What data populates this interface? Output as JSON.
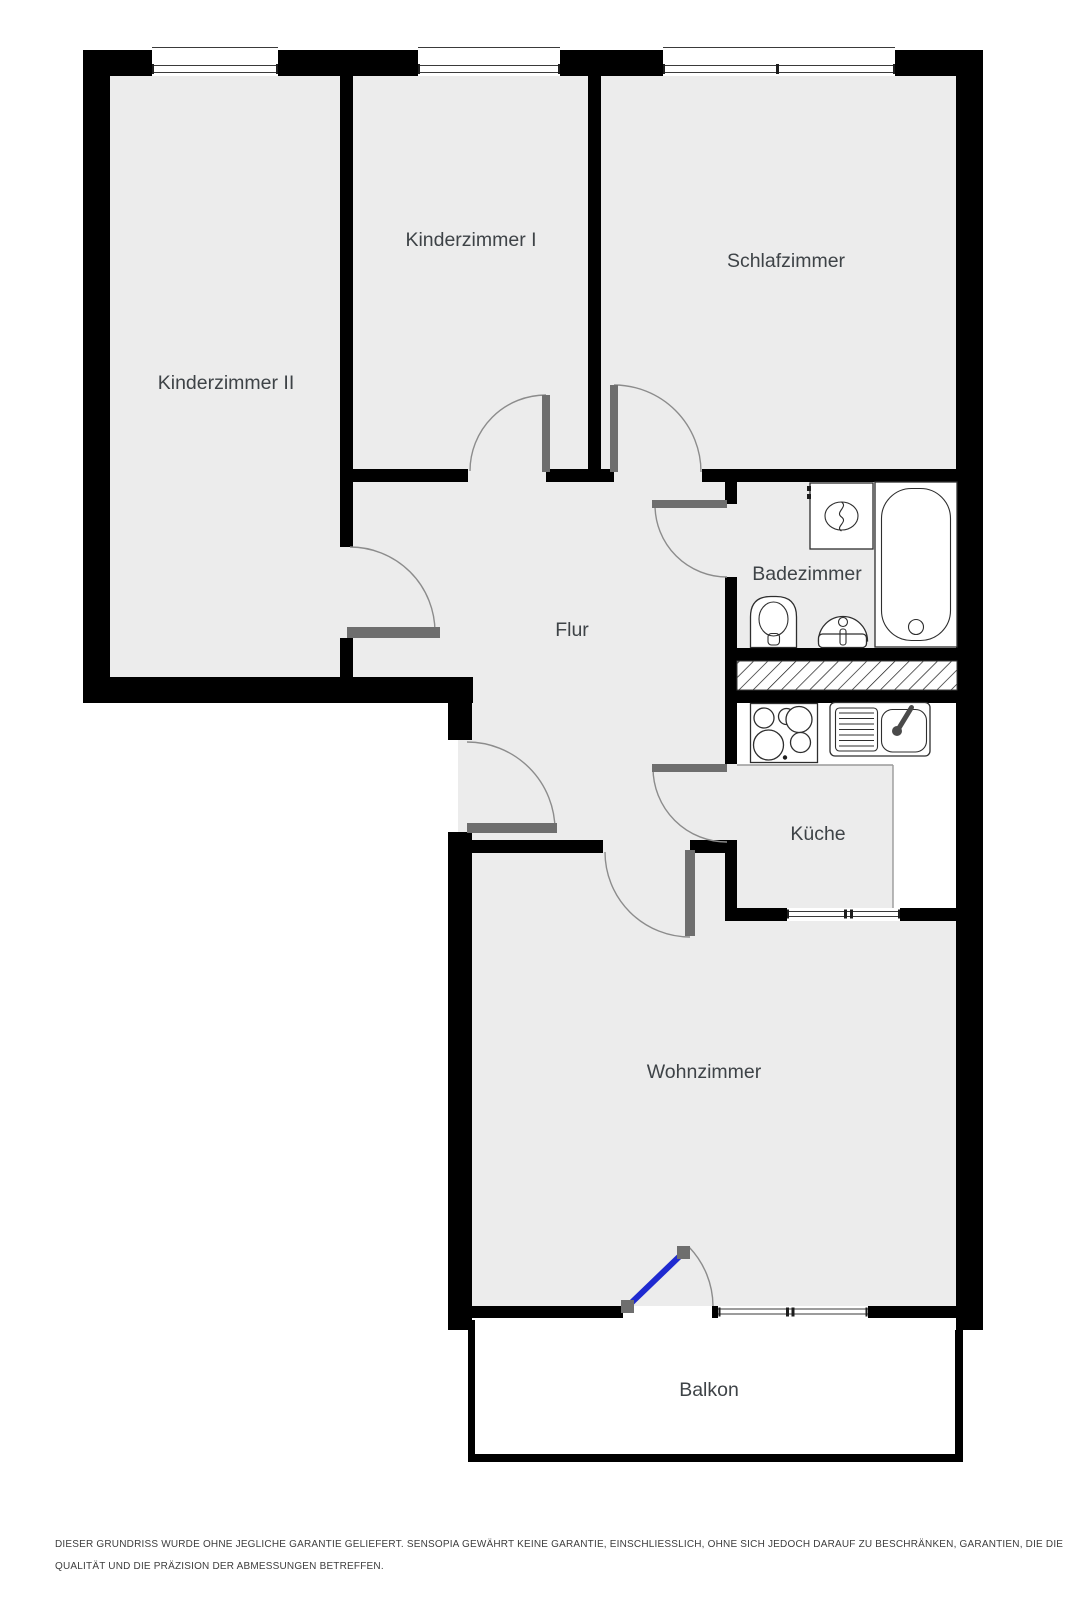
{
  "plan": {
    "title": "Wohnungsgrundriss",
    "rooms": [
      {
        "id": "kinderzimmer2",
        "label": "Kinderzimmer II"
      },
      {
        "id": "kinderzimmer1",
        "label": "Kinderzimmer I"
      },
      {
        "id": "schlafzimmer",
        "label": "Schlafzimmer"
      },
      {
        "id": "badezimmer",
        "label": "Badezimmer"
      },
      {
        "id": "flur",
        "label": "Flur"
      },
      {
        "id": "kueche",
        "label": "Küche"
      },
      {
        "id": "wohnzimmer",
        "label": "Wohnzimmer"
      },
      {
        "id": "balkon",
        "label": "Balkon"
      }
    ],
    "fixture_icons": [
      "washing-machine-icon",
      "bathtub-icon",
      "toilet-icon",
      "bathroom-sink-icon",
      "stove-icon",
      "kitchen-sink-icon",
      "shaft-hatch-icon",
      "window-icon",
      "door-swing-icon",
      "balcony-door-icon"
    ]
  },
  "colors": {
    "background": "#ffffff",
    "wall": "#000000",
    "floor": "#ececec",
    "door_leaf": "#6e6e6e",
    "swing_arc": "#8c8c8c",
    "balcony_door": "#1f2ad0",
    "label_text": "#3e4347",
    "disclaimer_text": "#3d3d3d"
  },
  "disclaimer": {
    "line1": "DIESER GRUNDRISS WURDE OHNE JEGLICHE GARANTIE GELIEFERT. SENSOPIA GEWÄHRT KEINE GARANTIE, EINSCHLIESSLICH, OHNE SICH JEDOCH DARAUF ZU BESCHRÄNKEN, GARANTIEN, DIE DIE",
    "line2": "QUALITÄT UND DIE PRÄZISION DER ABMESSUNGEN BETREFFEN."
  }
}
